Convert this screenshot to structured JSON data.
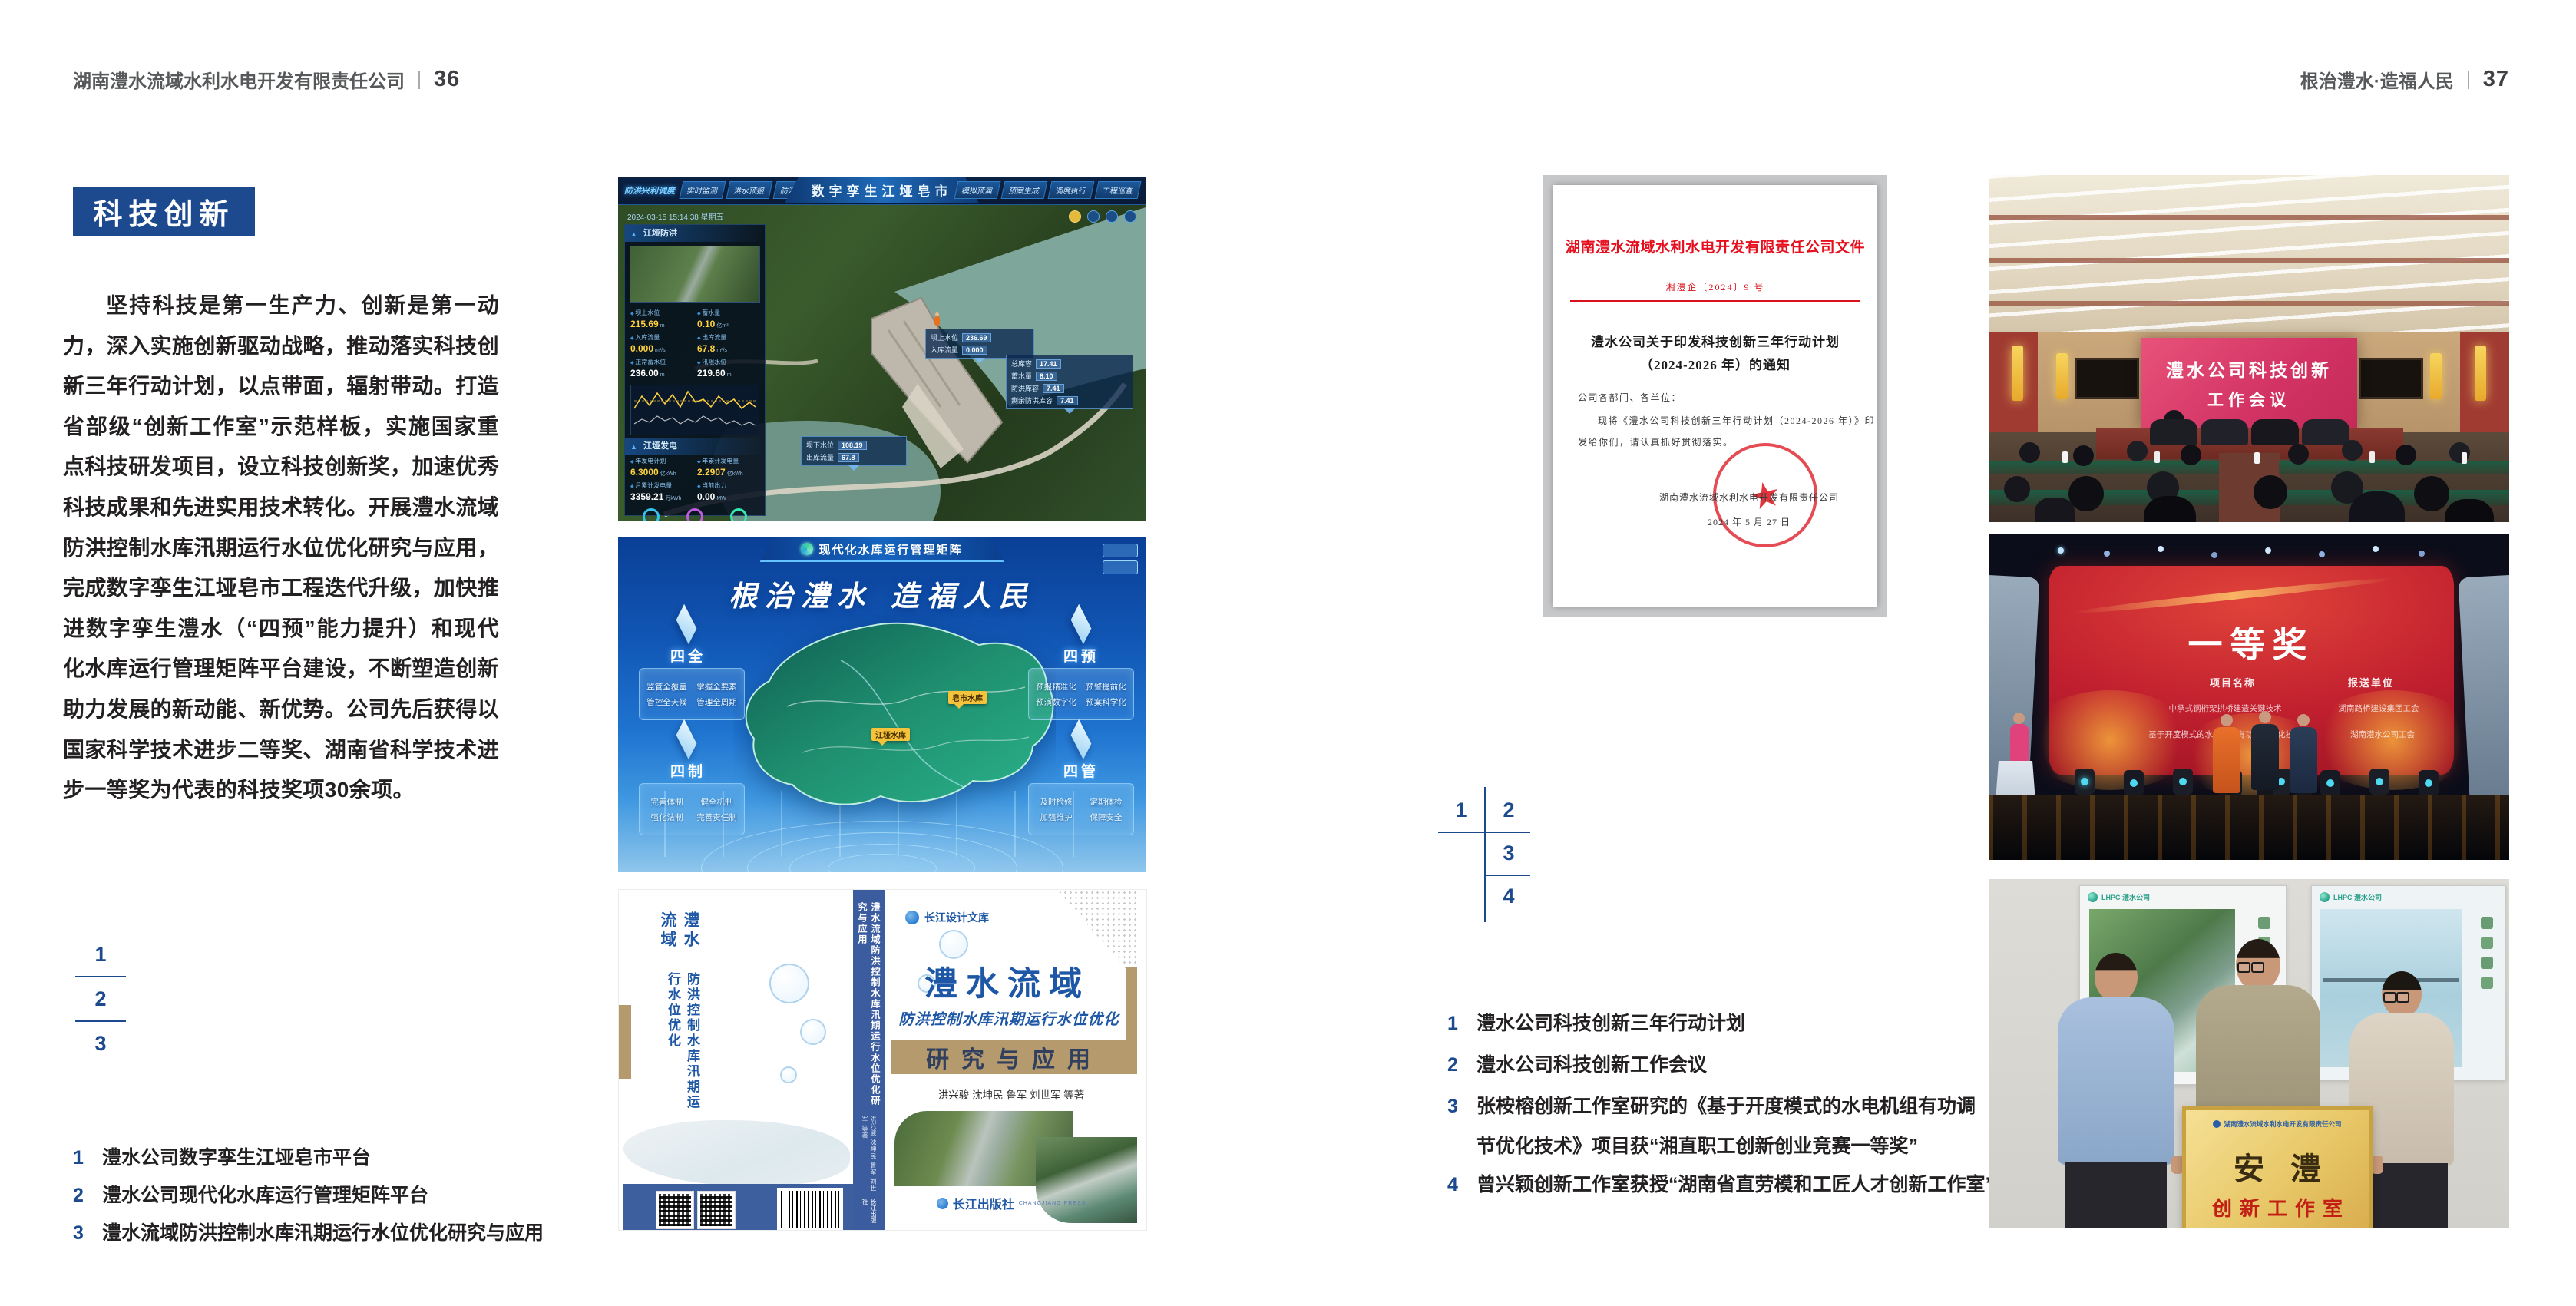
{
  "colors": {
    "accent_blue": "#1d4a8f",
    "text_dark": "#232021",
    "header_gray": "#56585a",
    "doc_red": "#d8131c"
  },
  "page_left": {
    "header": {
      "company": "湖南澧水流域水利水电开发有限责任公司",
      "page_number": "36"
    },
    "section_title": "科技创新",
    "body": "坚持科技是第一生产力、创新是第一动力，深入实施创新驱动战略，推动落实科技创新三年行动计划，以点带面，辐射带动。打造省部级“创新工作室”示范样板，实施国家重点科技研发项目，设立科技创新奖，加速优秀科技成果和先进实用技术转化。开展澧水流域防洪控制水库汛期运行水位优化研究与应用，完成数字孪生江垭皂市工程迭代升级，加快推进数字孪生澧水（“四预”能力提升）和现代化水库运行管理矩阵平台建设，不断塑造创新助力发展的新动能、新优势。公司先后获得以国家科学技术进步二等奖、湖南省科学技术进步一等奖为代表的科技奖项30余项。",
    "figure_nums": [
      "1",
      "2",
      "3"
    ],
    "captions": [
      {
        "num": "1",
        "text": "澧水公司数字孪生江垭皂市平台"
      },
      {
        "num": "2",
        "text": "澧水公司现代化水库运行管理矩阵平台"
      },
      {
        "num": "3",
        "text": "澧水流域防洪控制水库汛期运行水位优化研究与应用"
      }
    ]
  },
  "page_right": {
    "header": {
      "slogan": "根治澧水·造福人民",
      "page_number": "37"
    },
    "figure_nums": [
      "1",
      "2",
      "3",
      "4"
    ],
    "captions": [
      {
        "num": "1",
        "text": "澧水公司科技创新三年行动计划"
      },
      {
        "num": "2",
        "text": "澧水公司科技创新工作会议"
      },
      {
        "num": "3",
        "text": "张桉榕创新工作室研究的《基于开度模式的水电机组有功调节优化技术》项目获“湘直职工创新创业竞赛一等奖”"
      },
      {
        "num": "4",
        "text": "曾兴颖创新工作室获授“湖南省直劳模和工匠人才创新工作室”"
      }
    ]
  },
  "fig_dashboard": {
    "title": "数字孪生江垭皂市",
    "section_label": "防洪兴利调度",
    "tabs_left": [
      "实时监测",
      "洪水预报",
      "防洪预警"
    ],
    "tabs_right": [
      "模拟预演",
      "预案生成",
      "调度执行",
      "工程巡查"
    ],
    "datetime": "2024-03-15 15:14:38 星期五",
    "panel_top_title": "江垭防洪",
    "panel_bottom_title": "江垭发电",
    "stats": [
      {
        "label": "坝上水位",
        "value": "215.69",
        "unit": "m"
      },
      {
        "label": "蓄水量",
        "value": "0.10",
        "unit": "亿m³"
      },
      {
        "label": "入库流量",
        "value": "0.000",
        "unit": "m³/s"
      },
      {
        "label": "出库流量",
        "value": "67.8",
        "unit": "m³/s"
      },
      {
        "label": "正常蓄水位",
        "value": "236.00",
        "unit": "m"
      },
      {
        "label": "汛限水位",
        "value": "219.60",
        "unit": "m"
      }
    ],
    "gen_stats": [
      {
        "label": "年发电计划",
        "value": "6.3000",
        "unit": "亿kWh"
      },
      {
        "label": "年累计发电量",
        "value": "2.2907",
        "unit": "亿kWh"
      },
      {
        "label": "月累计发电量",
        "value": "3359.21",
        "unit": "万kWh"
      },
      {
        "label": "当前出力",
        "value": "0.00",
        "unit": "MW"
      }
    ],
    "popup1": [
      {
        "label": "坝上水位",
        "value": "236.69"
      },
      {
        "label": "入库流量",
        "value": "0.000"
      }
    ],
    "popup2": [
      {
        "label": "总库容",
        "value": "17.41"
      },
      {
        "label": "蓄水量",
        "value": "8.10"
      },
      {
        "label": "防洪库容",
        "value": "7.41"
      },
      {
        "label": "剩余防洪库容",
        "value": "7.41"
      }
    ],
    "popup3": [
      {
        "label": "坝下水位",
        "value": "108.19"
      },
      {
        "label": "出库流量",
        "value": "67.8"
      }
    ]
  },
  "fig_matrix": {
    "title": "现代化水库运行管理矩阵",
    "slogan": "根治澧水  造福人民",
    "modules": [
      {
        "label": "四全",
        "items": [
          "监管全覆盖",
          "掌握全要素",
          "管控全天候",
          "管理全周期"
        ]
      },
      {
        "label": "四预",
        "items": [
          "预报精准化",
          "预警提前化",
          "预演数字化",
          "预案科学化"
        ]
      },
      {
        "label": "四制",
        "items": [
          "完善体制",
          "健全机制",
          "强化法制",
          "完善责任制"
        ]
      },
      {
        "label": "四管",
        "items": [
          "及时检修",
          "定期体检",
          "加强维护",
          "保障安全"
        ]
      }
    ],
    "map_tags": [
      "皂市水库",
      "江垭水库"
    ]
  },
  "fig_book": {
    "series": "长江设计文库",
    "title_main": "澧水流域",
    "title_sub": "防洪控制水库汛期运行水位优化",
    "title_tail": "研究与应用",
    "authors": "洪兴骏  沈坤民  鲁军  刘世军  等著",
    "publisher": "长江出版社",
    "publisher_en": "CHANGJIANG PRESS",
    "spine_title": "澧水流域防洪控制水库汛期运行水位优化研究与应用"
  },
  "fig_document": {
    "header": "湖南澧水流域水利水电开发有限责任公司文件",
    "doc_no": "湘澧企〔2024〕9 号",
    "title_line1": "澧水公司关于印发科技创新三年行动计划",
    "title_line2": "（2024-2026 年）的通知",
    "salutation": "公司各部门、各单位：",
    "body_line1": "现将《澧水公司科技创新三年行动计划（2024-2026 年）》印",
    "body_line2": "发给你们，请认真抓好贯彻落实。",
    "seal_star": "★",
    "signer": "湖南澧水流域水利水电开发有限责任公司",
    "date": "2024 年 5 月 27 日"
  },
  "fig_meeting": {
    "screen_line1": "澧水公司科技创新",
    "screen_line2": "工作会议"
  },
  "fig_award": {
    "title": "一等奖",
    "col1": "项目名称",
    "col2": "报送单位",
    "rows": [
      {
        "project": "中承式钢桁架拱桥建造关键技术",
        "org": "湖南路桥建设集团工会"
      },
      {
        "project": "基于开度模式的水电机组有功调节优化技术",
        "org": "湖南澧水公司工会"
      }
    ]
  },
  "fig_plaque": {
    "plaque_header": "湖南澧水流域水利水电开发有限责任公司",
    "plaque_name": "安澧",
    "plaque_title": "创新工作室",
    "poster_logo": "LHPC 澧水公司"
  }
}
